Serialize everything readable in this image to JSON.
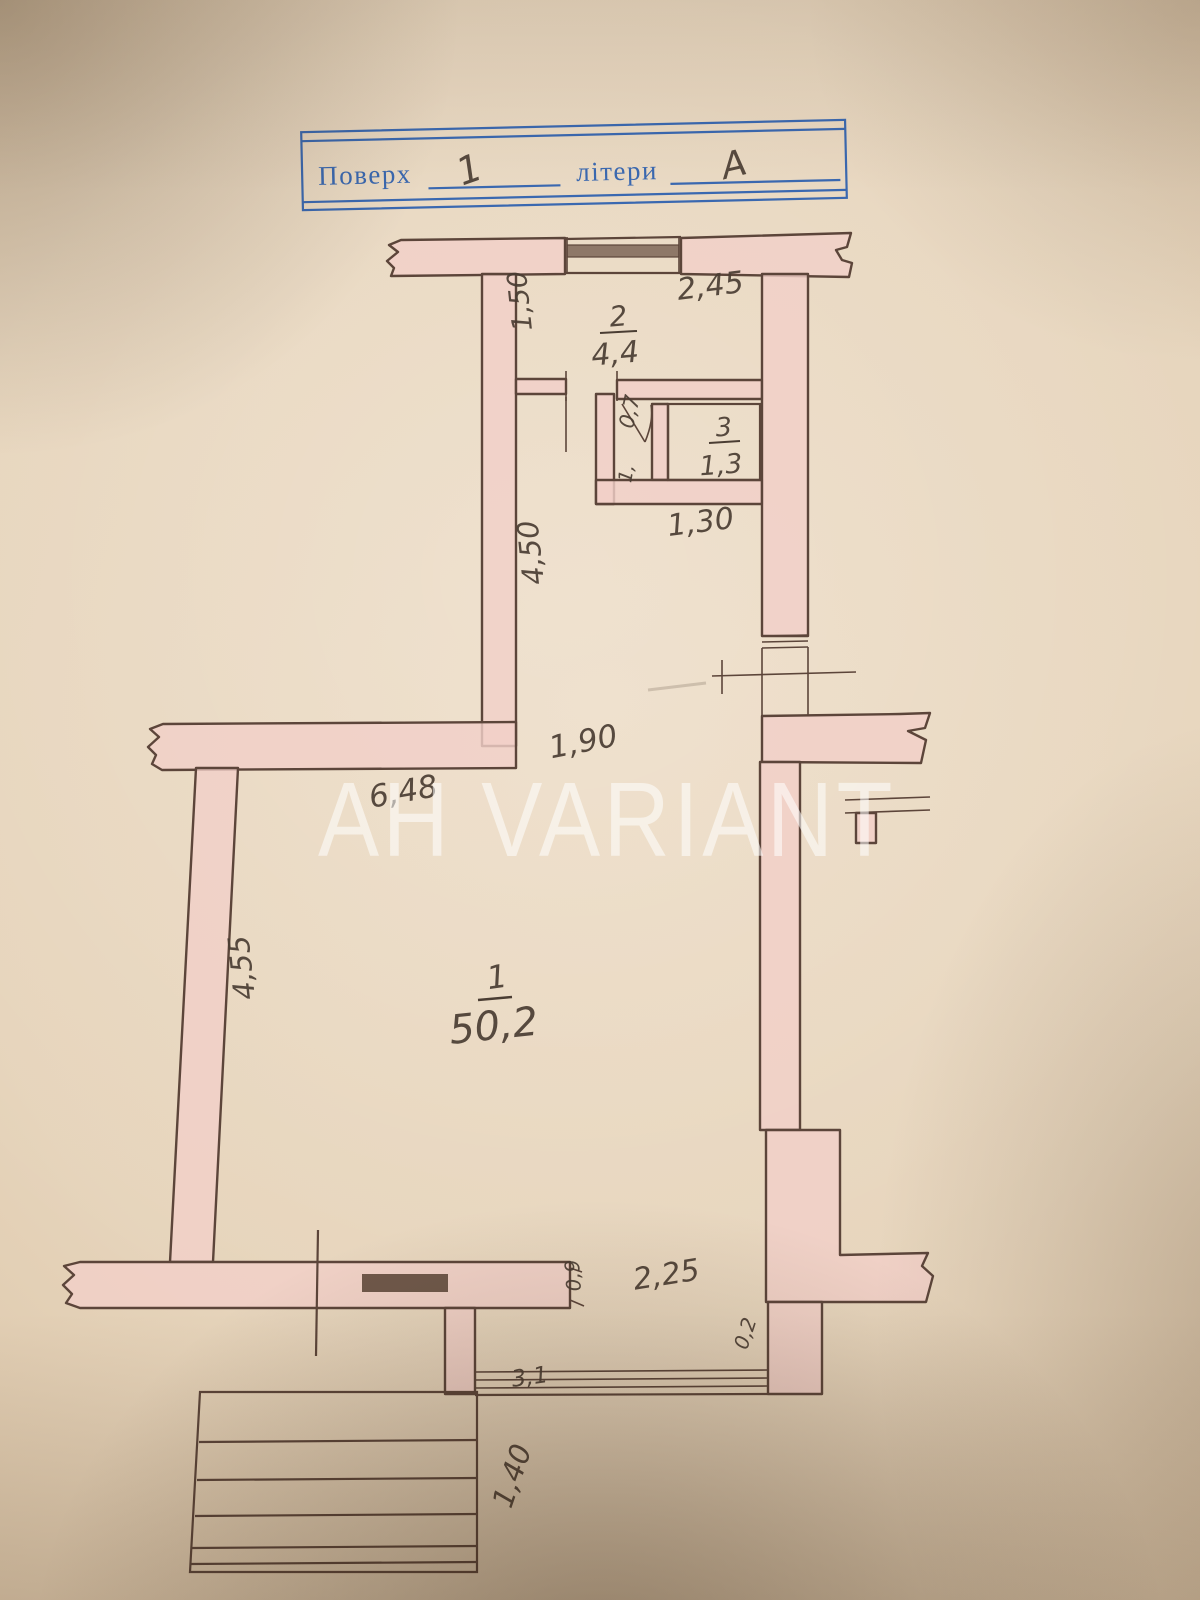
{
  "photo": {
    "stamp": {
      "floor_label": "Поверх",
      "floor_value": "1",
      "letters_label": "літери",
      "letters_value": "А"
    },
    "watermark": "АН VARIANT",
    "rooms": [
      {
        "number": "1",
        "area": "50,2"
      },
      {
        "number": "2",
        "area": "4,4"
      },
      {
        "number": "3",
        "area": "1,3"
      }
    ],
    "dimensions": {
      "room2_width": "2,45",
      "room2_depth": "1,50",
      "hall_door": "0,7",
      "hall_door_mark": "1,",
      "wc_width": "1,30",
      "corridor_length": "4,50",
      "passage_width": "1,90",
      "room1_width": "6,48",
      "room1_depth": "4,55",
      "rear_opening": "2,25",
      "rear_door": "0,9",
      "vestibule_window": "3,1",
      "wall_mark": "0,2",
      "stairs_width": "1,40"
    },
    "colors": {
      "paper": "#e6d4bb",
      "wall_fill": "#f2d0c8",
      "line": "#5c453a",
      "stamp_blue": "#3a68b0",
      "ink": "#4a3d33",
      "watermark": "rgba(255,255,255,0.55)"
    }
  }
}
